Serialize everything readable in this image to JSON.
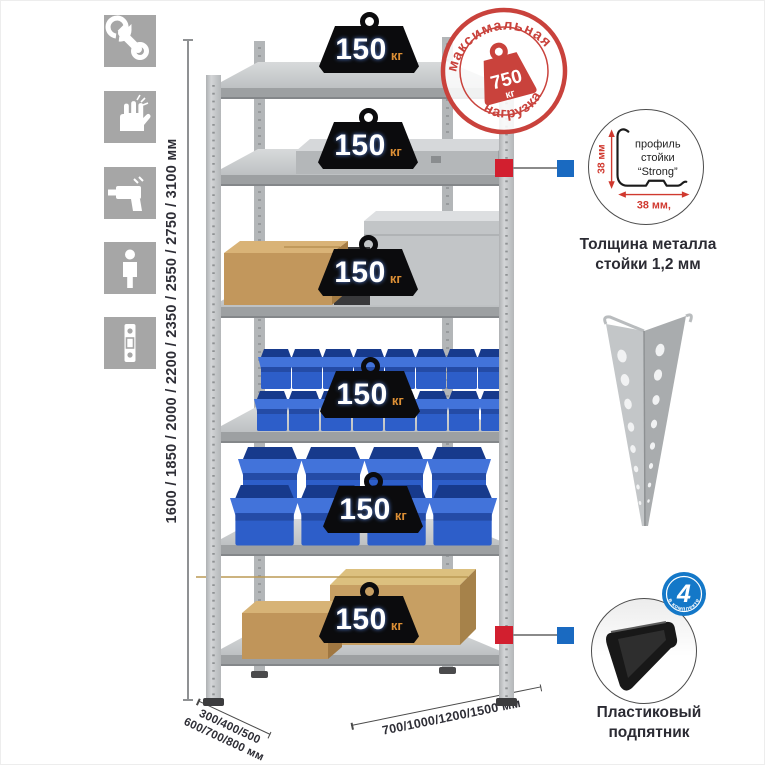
{
  "sidebar": {
    "icons": [
      {
        "name": "wrench"
      },
      {
        "name": "work-gloves"
      },
      {
        "name": "drill"
      },
      {
        "name": "person-height"
      },
      {
        "name": "perforated-post"
      }
    ]
  },
  "dimensions": {
    "height": "1600 / 1850 / 2000 / 2200 / 2350 / 2550 / 2750 / 3100 мм",
    "depth_line1": "300/400/500",
    "depth_line2": "600/700/800 мм",
    "width": "700/1000/1200/1500 мм"
  },
  "max_load_stamp": {
    "arc_top": "максимальная",
    "arc_bottom": "нагрузка",
    "value": "750",
    "unit": "кг"
  },
  "shelf_load": {
    "value": "150",
    "unit": "кг",
    "shelves": 6
  },
  "profile_callout": {
    "label_line1": "профиль",
    "label_line2": "стойки",
    "label_line3": "“Strong”",
    "dim_height": "38 мм",
    "dim_width": "38 мм,",
    "caption_line1": "Толщина металла",
    "caption_line2": "стойки 1,2 мм"
  },
  "foot_callout": {
    "badge_value": "4",
    "badge_text": "в комплекте",
    "caption_line1": "Пластиковый",
    "caption_line2": "подпятник"
  },
  "palette": {
    "icon_bg": "#a6a6a6",
    "stamp_red": "#c9423c",
    "marker_red": "#d21f2f",
    "marker_blue": "#1a6ac1",
    "weight_black": "#0b0b0d",
    "weight_unit_orange": "#dc8f35",
    "bin_blue": "#2d5ec9",
    "dim_text": "#2e2e36"
  }
}
